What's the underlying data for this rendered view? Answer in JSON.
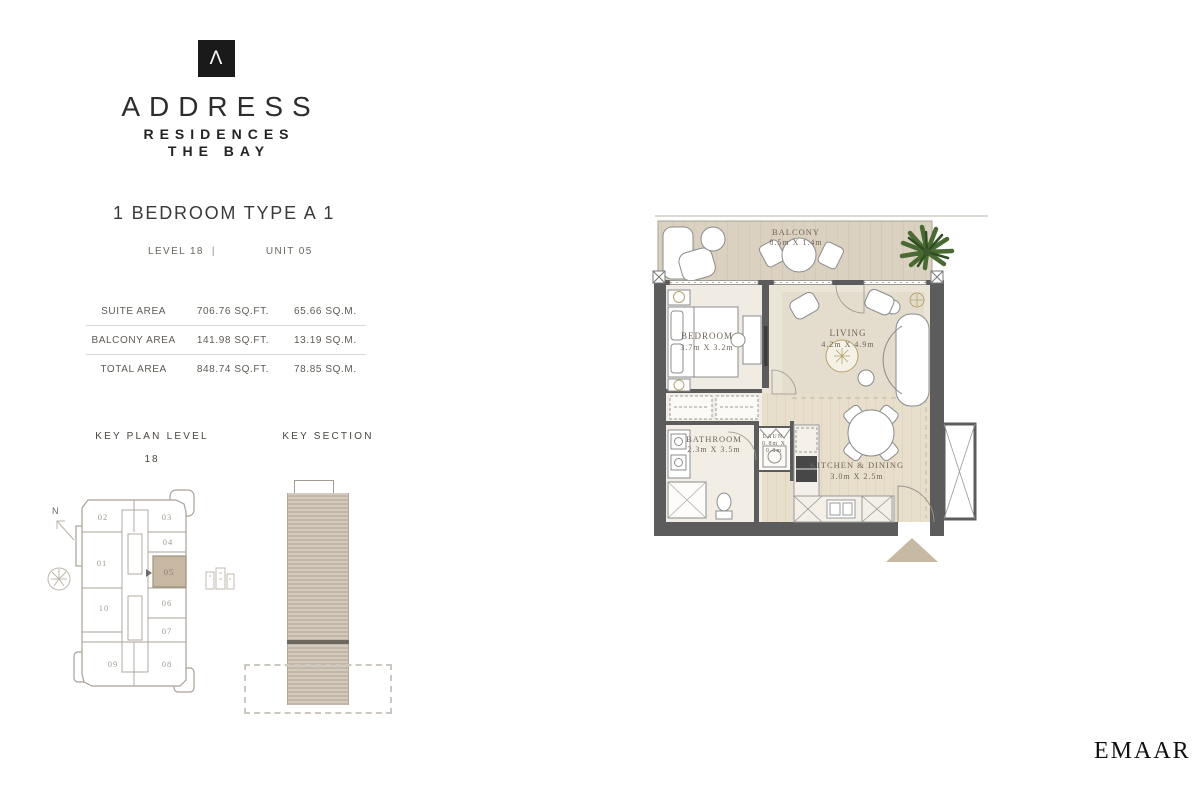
{
  "brand": {
    "logo_letter": "Λ",
    "name": "ADDRESS",
    "line2": "RESIDENCES",
    "line3": "THE BAY"
  },
  "unit": {
    "title": "1 BEDROOM TYPE A 1",
    "level": "LEVEL 18",
    "divider": "|",
    "number": "UNIT 05"
  },
  "areas": {
    "rows": [
      {
        "label": "SUITE AREA",
        "sqft": "706.76 SQ.FT.",
        "sqm": "65.66 SQ.M."
      },
      {
        "label": "BALCONY AREA",
        "sqft": "141.98 SQ.FT.",
        "sqm": "13.19 SQ.M."
      },
      {
        "label": "TOTAL AREA",
        "sqft": "848.74 SQ.FT.",
        "sqm": "78.85 SQ.M."
      }
    ]
  },
  "key_plan": {
    "title": "KEY PLAN LEVEL",
    "level": "18",
    "north": "N",
    "highlighted_unit": "05",
    "units": [
      "01",
      "02",
      "03",
      "04",
      "05",
      "06",
      "07",
      "08",
      "09",
      "10"
    ]
  },
  "key_section": {
    "title": "KEY SECTION"
  },
  "floor_plan": {
    "balcony": {
      "name": "BALCONY",
      "dim": "8.5m X 1.4m"
    },
    "bedroom": {
      "name": "BEDROOM",
      "dim": "3.7m X 3.2m"
    },
    "living": {
      "name": "LIVING",
      "dim": "4.2m X 4.9m"
    },
    "bathroom": {
      "name": "BATHROOM",
      "dim": "2.3m X 3.5m"
    },
    "laundry": {
      "name": "LAUN.",
      "dim_line1": "0.8m X",
      "dim_line2": "0.8m"
    },
    "kitchen": {
      "name": "KITCHEN & DINING",
      "dim": "3.0m X 2.5m"
    }
  },
  "footer": {
    "brand": "EMAAR"
  },
  "colors": {
    "accent_tan": "#c8b7a3",
    "entry_arrow": "#c8b9a5",
    "wall_gray": "#5c5c5c",
    "plan_text": "#6f6557",
    "keyplan_text": "#a09a90"
  }
}
